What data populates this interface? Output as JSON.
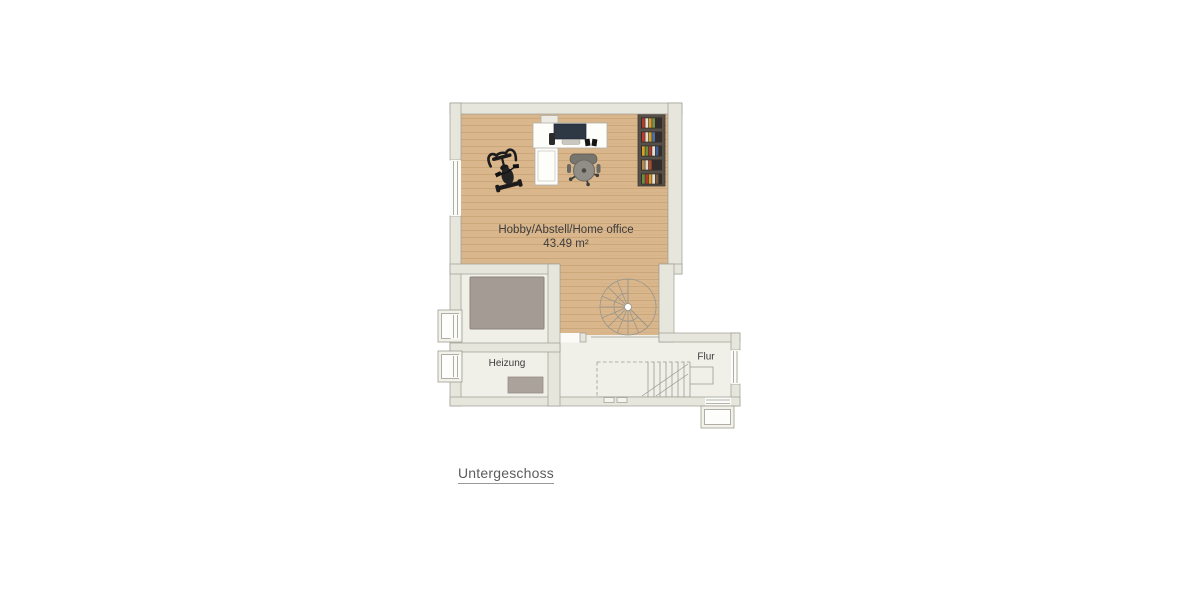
{
  "title": {
    "text": "Untergeschoss"
  },
  "rooms": {
    "hobby": {
      "name": "Hobby/Abstell/Home office",
      "area": "43.49 m²"
    },
    "heizung": {
      "name": "Heizung"
    },
    "flur": {
      "name": "Flur"
    }
  },
  "palette": {
    "wood_floor": "#d9b68c",
    "wood_seam": "#c8a274",
    "wall_fill": "#e6e6dd",
    "wall_line": "#9c9c93",
    "hard_floor": "#f0efe8",
    "equipment_gray": "#a49b94",
    "label_text": "#3c3c3c",
    "title_text": "#5c5c5c"
  },
  "furniture": [
    "desk",
    "monitor",
    "office-chair",
    "exercise-bike",
    "bookshelf",
    "printer",
    "storage-tank",
    "heater-unit",
    "spiral-staircase",
    "straight-staircase"
  ],
  "bookshelf": {
    "frame_color": "#575049",
    "cell_color": "#332e2b",
    "cells": [
      [
        "#b23b2e",
        "#e8e2d4",
        "#d79c2d",
        "#7a8f4a"
      ],
      [
        "#c0392b",
        "#e4ddcf",
        "#caa12f",
        "#4f6f9f"
      ],
      [
        "#d7a02c",
        "#69903f",
        "#b23b2e",
        "#e6e0d2",
        "#3f5f8e"
      ],
      [
        "#b98a4f",
        "#e2dccd",
        "#ad4a2f"
      ],
      [
        "#69903f",
        "#b23b2e",
        "#d7a02c",
        "#e6e0d2",
        "#7a5c3e"
      ]
    ]
  }
}
